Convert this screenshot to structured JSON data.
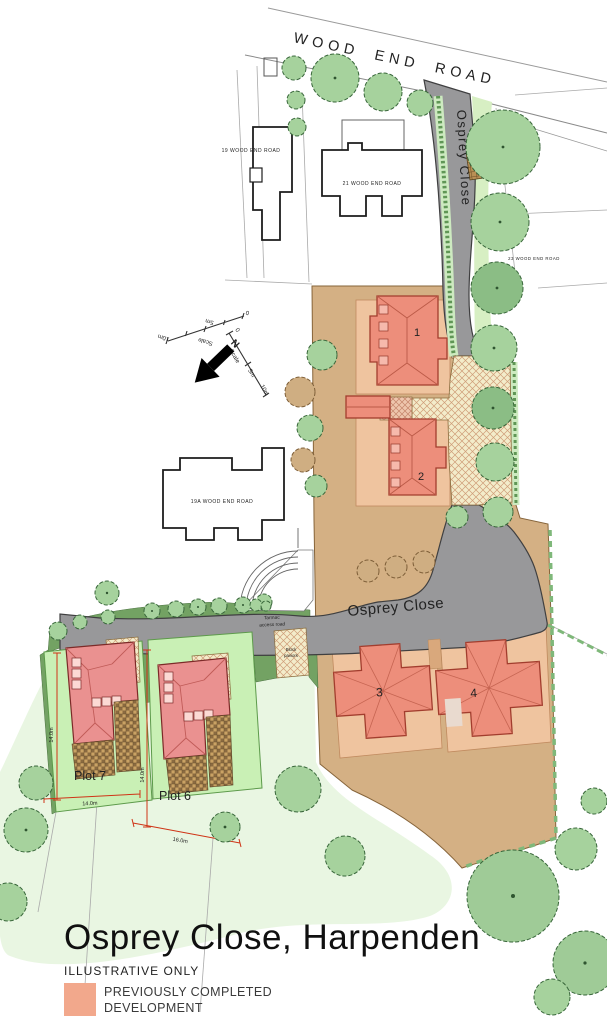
{
  "title": "Osprey Close, Harpenden",
  "subtitle": "ILLUSTRATIVE ONLY",
  "legend": {
    "swatch_color": "#f2a88c",
    "label_line1": "PREVIOUSLY COMPLETED",
    "label_line2": "DEVELOPMENT"
  },
  "roads": {
    "wood_end_road": "WOOD END ROAD",
    "osprey_close": "Osprey Close"
  },
  "labels": {
    "tarmac_line1": "Tarmac",
    "tarmac_line2": "access road",
    "block_line1": "Block",
    "block_line2": "paviors",
    "north": "N",
    "scale": "Scale",
    "scale_ticks": [
      "0",
      "5m",
      "10m"
    ]
  },
  "neighbors": {
    "n19": "19 WOOD END ROAD",
    "n21": "21 WOOD END ROAD",
    "n23": "23 WOOD END ROAD",
    "n19a": "19A WOOD END ROAD"
  },
  "completed_plots": {
    "p1": "1",
    "p2": "2",
    "p3": "3",
    "p4": "4"
  },
  "proposed_plots": {
    "plot7": "Plot 7",
    "plot6": "Plot 6"
  },
  "dimensions": {
    "plot7_depth": "14.0m",
    "plot7_width": "14.0m",
    "plot6_depth": "14.0m",
    "plot6_width": "16.0m"
  }
}
